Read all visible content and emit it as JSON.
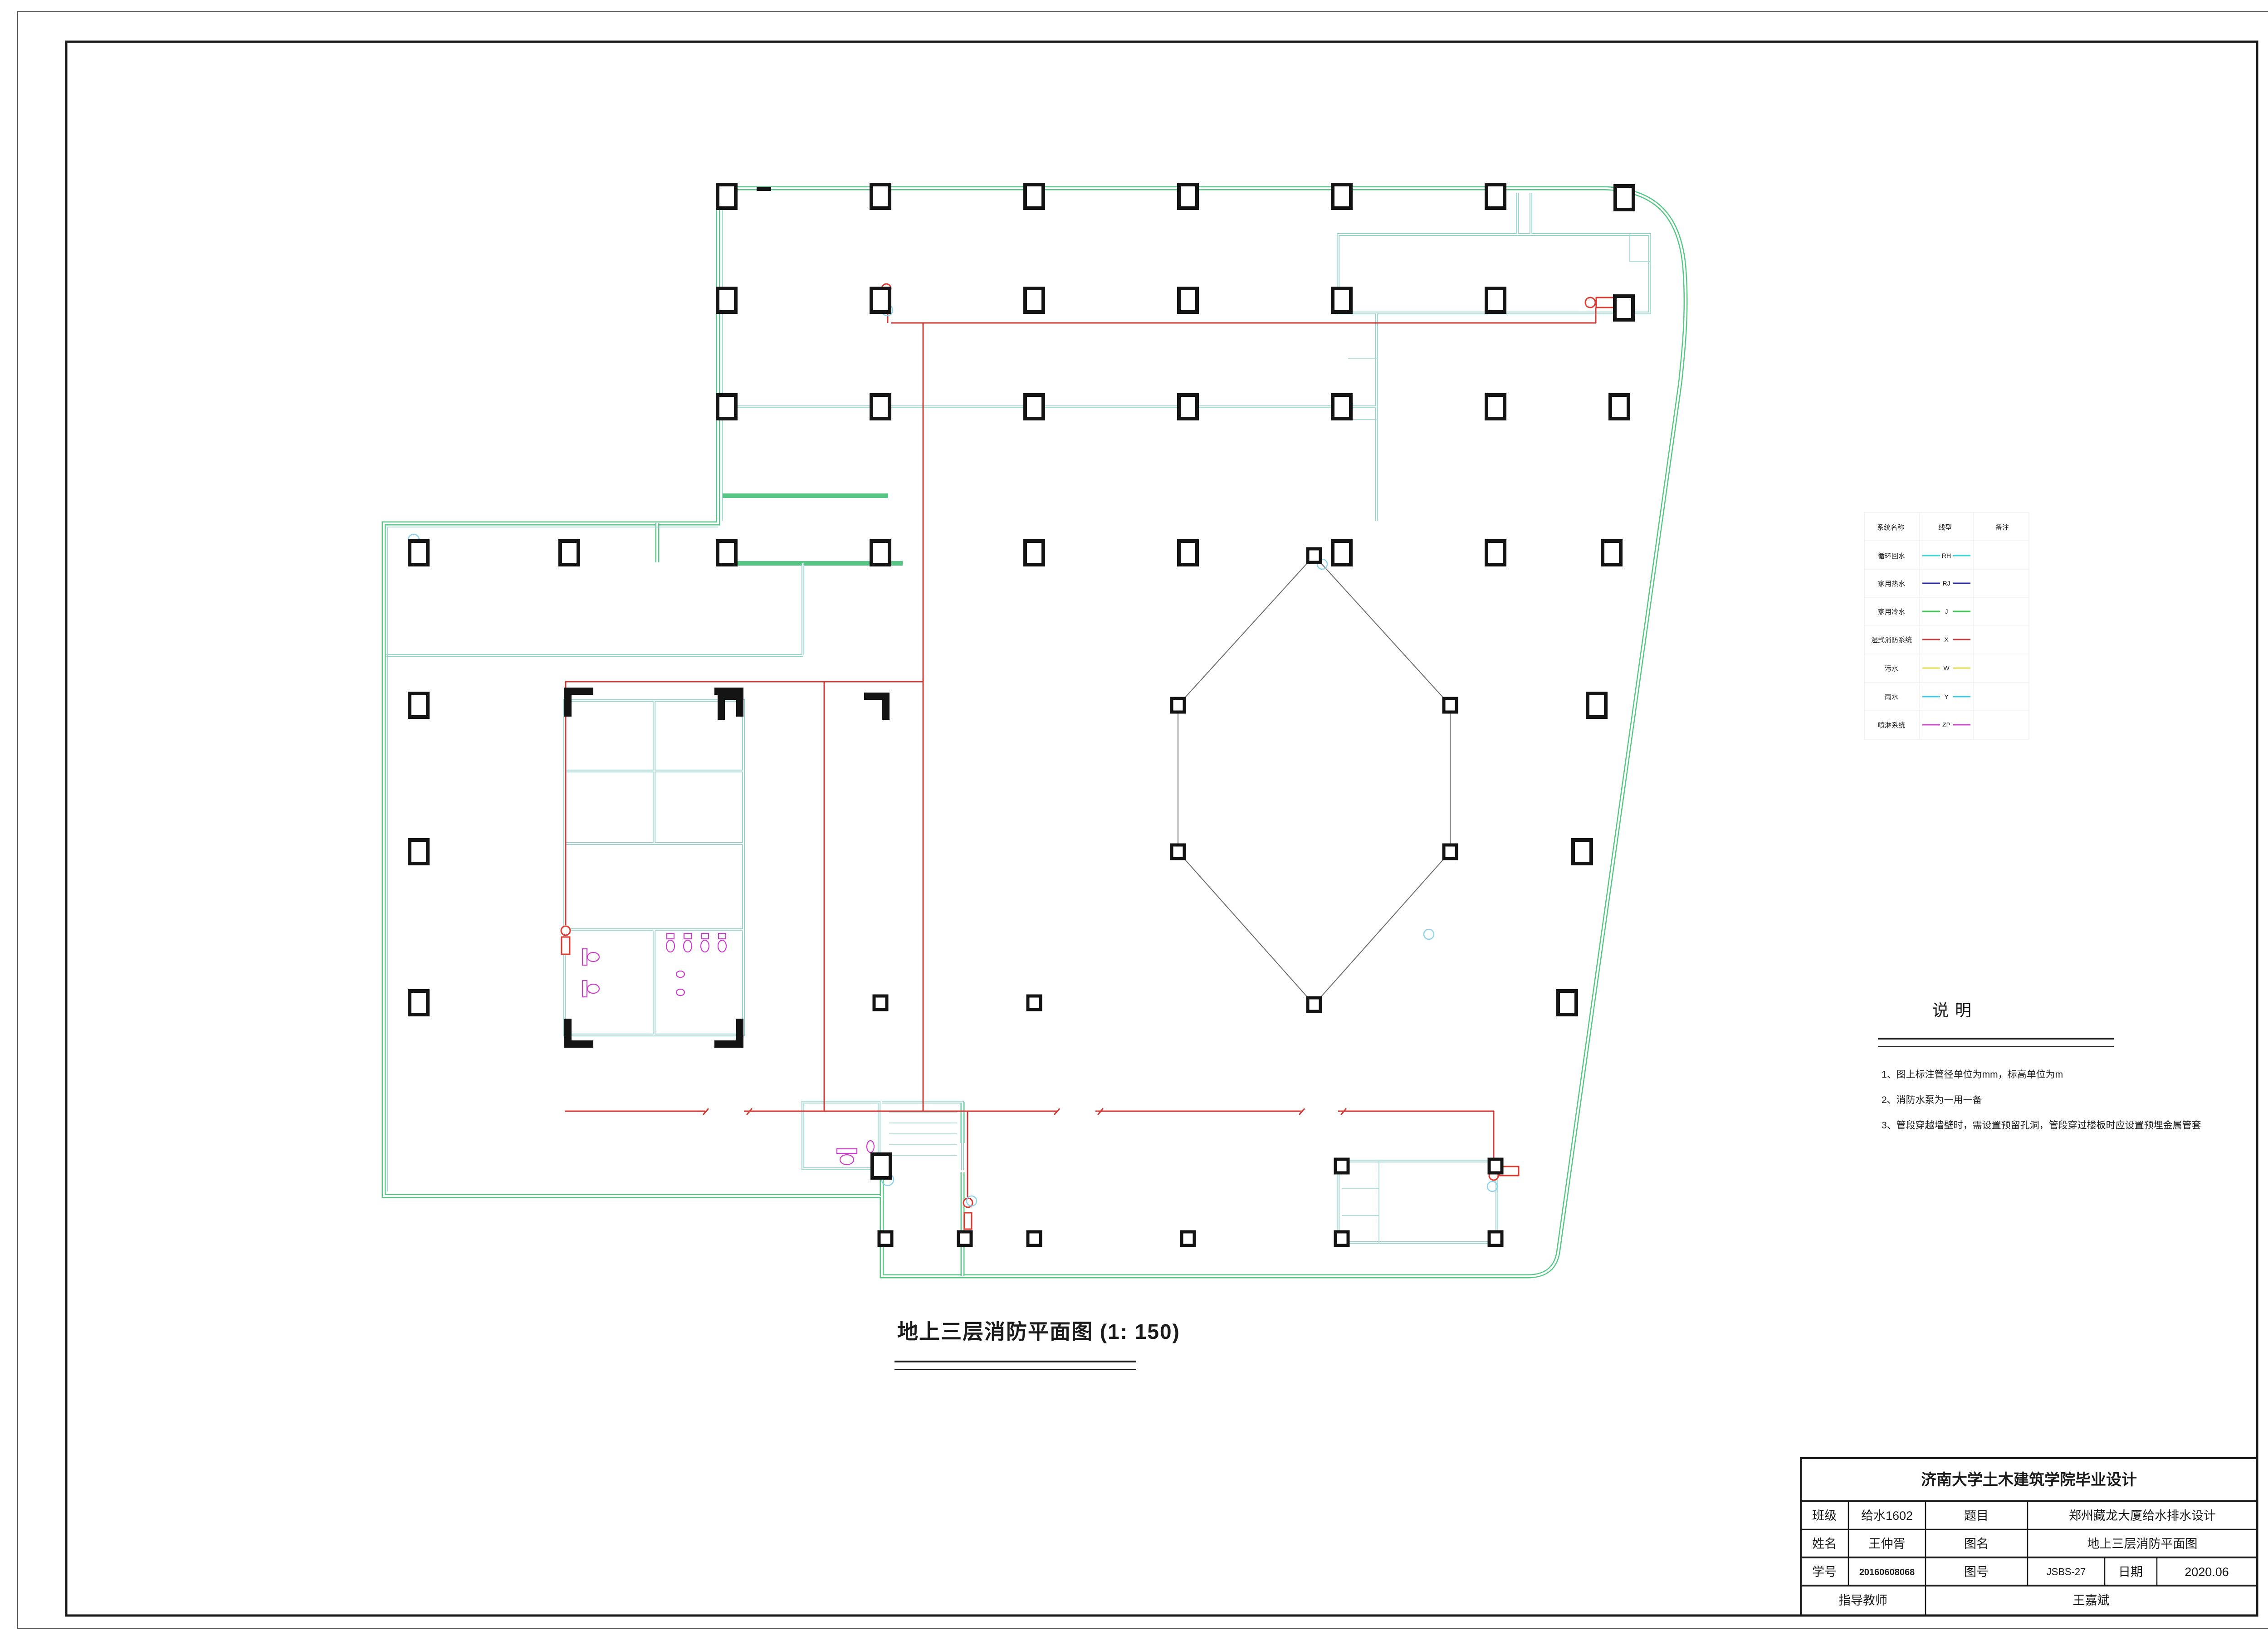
{
  "plan": {
    "caption": "地上三层消防平面图 (1: 150)"
  },
  "legend": {
    "headers": [
      "系统名称",
      "线型",
      "备注"
    ],
    "rows": [
      {
        "name": "循环回水",
        "code": "RH",
        "color": "#3FD6D6"
      },
      {
        "name": "家用热水",
        "code": "RJ",
        "color": "#2B2BA8"
      },
      {
        "name": "家用冷水",
        "code": "J",
        "color": "#3FCC55"
      },
      {
        "name": "湿式消防系统",
        "code": "X",
        "color": "#CC3A3A"
      },
      {
        "name": "污水",
        "code": "W",
        "color": "#E5DE3D"
      },
      {
        "name": "雨水",
        "code": "Y",
        "color": "#3FC9E0"
      },
      {
        "name": "喷淋系统",
        "code": "ZP",
        "color": "#C94FC9"
      }
    ]
  },
  "notes": {
    "title": "说明",
    "items": [
      "1、图上标注管径单位为mm，标高单位为m",
      "2、消防水泵为一用一备",
      "3、管段穿越墙壁时，需设置预留孔洞，管段穿过楼板时应设置预埋金属管套"
    ]
  },
  "title_block": {
    "school": "济南大学土木建筑学院毕业设计",
    "rows": [
      {
        "label": "班级",
        "value": "给水1602",
        "label2": "题目",
        "value2": "郑州藏龙大厦给水排水设计"
      },
      {
        "label": "姓名",
        "value": "王仲胥",
        "label2": "图名",
        "value2": "地上三层消防平面图"
      },
      {
        "label": "学号",
        "value": "20160608068",
        "label2": "图号",
        "value2": "JSBS-27",
        "label3": "日期",
        "value3": "2020.06"
      },
      {
        "label": "指导教师",
        "value": "王嘉斌"
      }
    ]
  },
  "colors": {
    "exterior_wall": "#57C785",
    "partition": "#8ED1C8",
    "fire_pipe": "#CB3A34",
    "fixture": "#CC3FCC",
    "sprinkler": "#8FD2EA",
    "column": "#141414"
  }
}
